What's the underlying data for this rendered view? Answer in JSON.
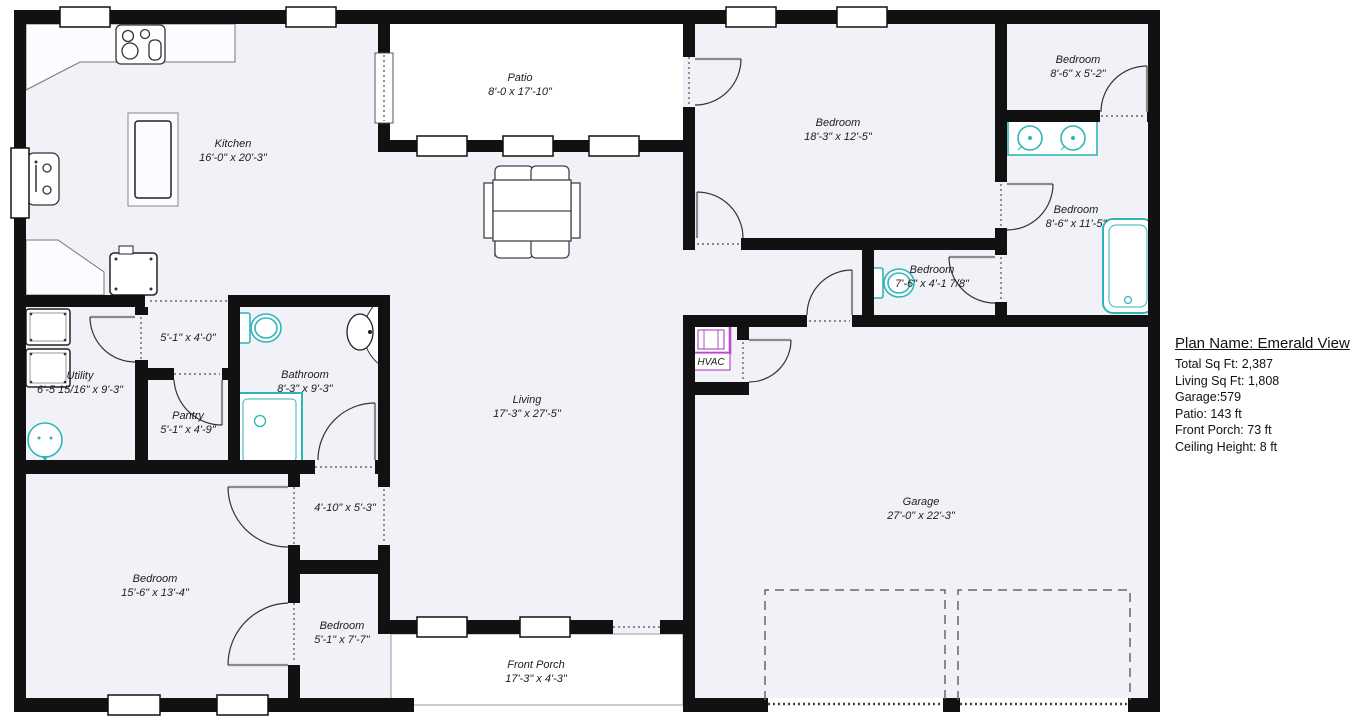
{
  "plan_info": {
    "title": "Plan Name: Emerald View",
    "details": [
      "Total Sq Ft: 2,387",
      "Living Sq Ft: 1,808",
      "Garage:579",
      "Patio: 143 ft",
      "Front Porch: 73 ft",
      "Ceiling Height: 8 ft"
    ]
  },
  "rooms": [
    {
      "name": "Kitchen",
      "dims": "16'-0\" x 20'-3\""
    },
    {
      "name": "Patio",
      "dims": "8'-0 x 17'-10\""
    },
    {
      "name": "Bedroom",
      "dims": "18'-3\" x 12'-5\""
    },
    {
      "name": "Bedroom",
      "dims": "8'-6\" x 5'-2\""
    },
    {
      "name": "Bedroom",
      "dims": "8'-6\" x 11'-5\""
    },
    {
      "name": "Bedroom",
      "dims": "7'-6\" x 4'-1 7/8\""
    },
    {
      "name": "HVAC",
      "dims": ""
    },
    {
      "name": "Living",
      "dims": "17'-3\" x 27'-5\""
    },
    {
      "name": "",
      "dims": "5'-1\" x 4'-0\""
    },
    {
      "name": "Bathroom",
      "dims": "8'-3\" x 9'-3\""
    },
    {
      "name": "Utility",
      "dims": "6'-5 15/16\" x 9'-3\""
    },
    {
      "name": "Pantry",
      "dims": "5'-1\" x 4'-9\""
    },
    {
      "name": "Bedroom",
      "dims": "15'-6\" x 13'-4\""
    },
    {
      "name": "",
      "dims": "4'-10\" x 5'-3\""
    },
    {
      "name": "Bedroom",
      "dims": "5'-1\" x 7'-7\""
    },
    {
      "name": "Front Porch",
      "dims": "17'-3\" x 4'-3\""
    },
    {
      "name": "Garage",
      "dims": "27'-0\" x 22'-3\""
    }
  ],
  "colors": {
    "wall": "#111111",
    "floor_tint": "#f0f2f8",
    "fixture_teal": "#2fb5b7",
    "fixture_purple": "#b44fc8"
  },
  "fixture_icons": [
    "stove-icon",
    "kitchen-sink-icon",
    "refrigerator-icon",
    "kitchen-island",
    "dining-table-icon",
    "toilet-icon",
    "shower-icon",
    "pedestal-sink-icon",
    "washer-icon",
    "dryer-icon",
    "laundry-tub-icon",
    "double-vanity-icon",
    "bathtub-icon",
    "hvac-unit-icon"
  ]
}
